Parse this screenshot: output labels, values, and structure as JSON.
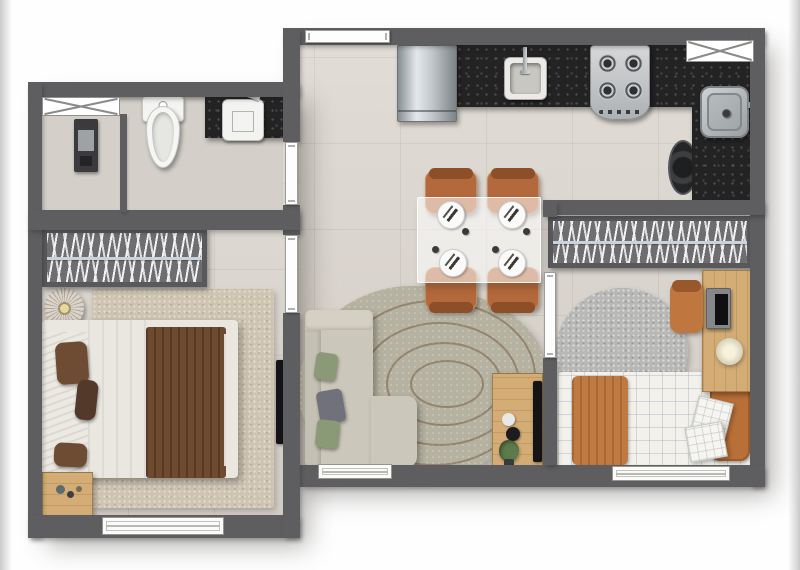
{
  "canvas": {
    "width": 800,
    "height": 570,
    "background": "#fefefe"
  },
  "plan_type": "apartment-floor-plan-top-view",
  "visible_text": [],
  "palette": {
    "wall": "#5e5e60",
    "floor": "#d9d3cb",
    "floor_bath": "#d4d0c9",
    "granite": "#232324",
    "frame": "#8f8f8f",
    "wood_light": "#d4ad76",
    "terracotta": "#b3693c",
    "terracotta_dark": "#8d4f28",
    "orange_textile": "#bf7a42",
    "brown_blanket": "#6e4a2f",
    "pillow_brown": "#6d4c33",
    "sofa": "#ccc7bb",
    "cushion_green": "#8a9a77",
    "cushion_gray": "#71717c",
    "rug_living": "#b5b2a1",
    "rug_contour": "#76563c",
    "rug_bed1": "#cec4b1",
    "rug_bed2": "#b8b8b6",
    "wardrobe_bg": "#6e6e71",
    "wardrobe_frame": "#59595c",
    "hanger_white": "#f2f2f4",
    "rod_blue": "#c8d3dd",
    "tv_black": "#141416",
    "plant": "#5d7a4b",
    "pouf": "#c2a061",
    "bed2_sheet": "#f2f1ec"
  },
  "regions": [
    "hall",
    "kitchen",
    "bathroom",
    "bedroom-1",
    "living-dining",
    "bedroom-2"
  ],
  "fixtures": [
    "entry-door",
    "refrigerator",
    "kitchen-sink",
    "stove",
    "kitchen-window",
    "laundry-tank",
    "washing-machine",
    "bathroom-window",
    "shower-column",
    "toilet",
    "bathroom-sink",
    "bathroom-door",
    "bedroom-1-door",
    "bedroom-2-door",
    "wardrobe",
    "pouf",
    "double-bed",
    "nightstand",
    "tv",
    "bedroom-1-window",
    "dining-table",
    "dining-chair",
    "plate",
    "sofa",
    "living-rug",
    "tv-console",
    "plant",
    "living-window",
    "single-bed",
    "desk",
    "desk-chair",
    "desk-lamp",
    "round-rug",
    "bedroom-2-window"
  ]
}
